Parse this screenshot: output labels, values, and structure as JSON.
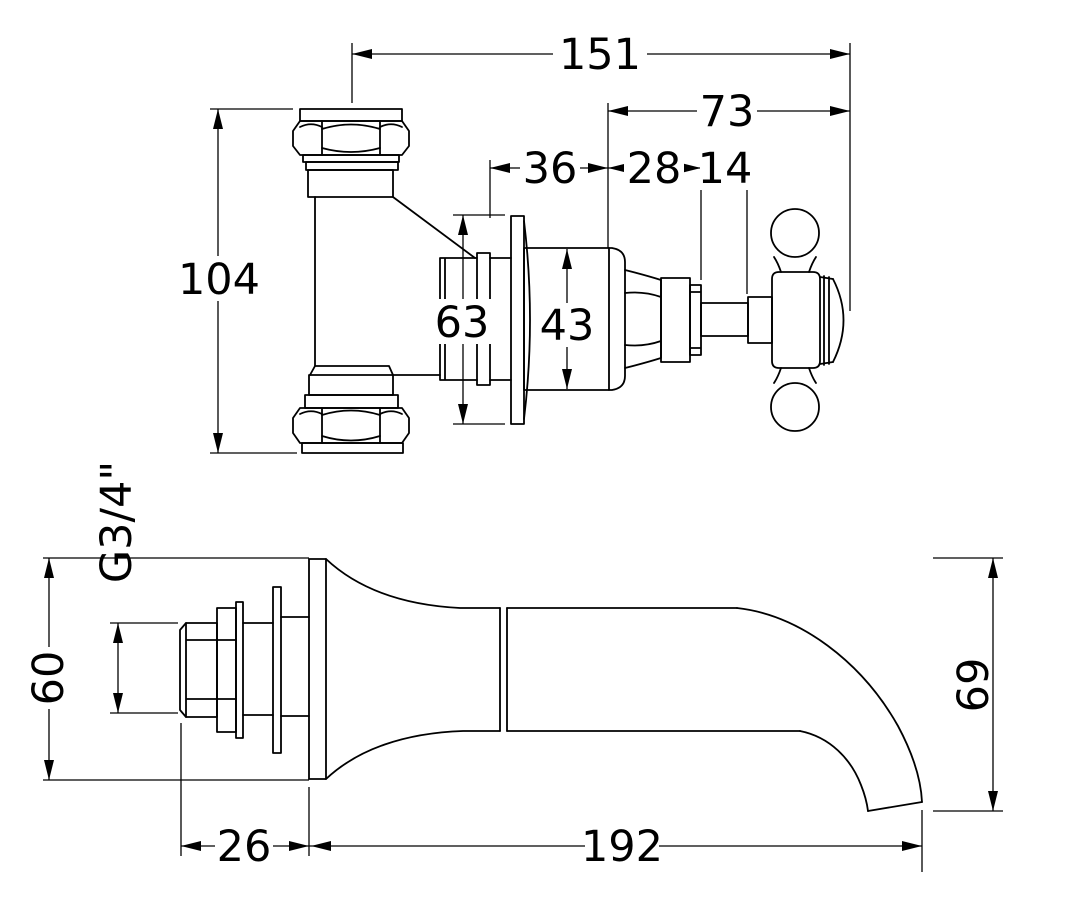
{
  "page": {
    "background": "#ffffff",
    "line_color": "#000000"
  },
  "drawing": {
    "kind": "technical-dimension-drawing",
    "subject": "wall-mounted tap: concealed valve with cross handle (upper view) and bath spout (lower view)"
  },
  "dimensions": {
    "valve_width": "151",
    "handle_projection": "73",
    "flange_face_depth": "36",
    "cap_to_stem": "28",
    "stem_length": "14",
    "valve_height": "104",
    "flange_diameter": "63",
    "body_diameter": "43",
    "thread_size": "G3/4\"",
    "spout_flange_diameter": "60",
    "tail_length": "26",
    "spout_reach": "192",
    "spout_drop": "69"
  }
}
